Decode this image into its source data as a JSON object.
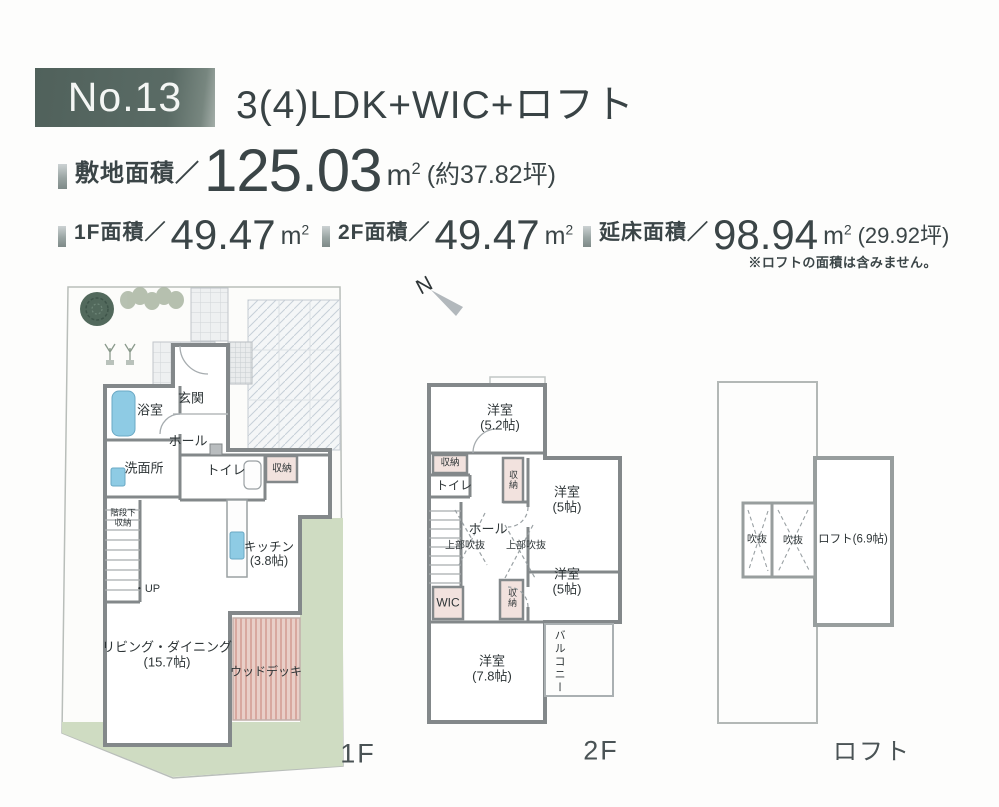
{
  "header": {
    "number": "No.13",
    "title": "3(4)LDK+WIC+ロフト"
  },
  "stats": {
    "unit": "m",
    "unit_sup": "2",
    "site_label": "敷地面積／",
    "site_value": "125.03",
    "site_note": "(約37.82坪)",
    "f1_label": "1F面積／",
    "f1_value": "49.47",
    "f2_label": "2F面積／",
    "f2_value": "49.47",
    "total_label": "延床面積／",
    "total_value": "98.94",
    "total_note": "(29.92坪)",
    "loft_note": "※ロフトの面積は含みません。"
  },
  "compass": {
    "north": "N"
  },
  "plan1f": {
    "floor_label": "1F",
    "rooms": {
      "bath": "浴室",
      "entrance": "玄関",
      "hall": "ホール",
      "washroom": "洗面所",
      "toilet": "トイレ",
      "storage": "収納",
      "under_stairs_line1": "階段下",
      "under_stairs_line2": "収納",
      "up": "・UP",
      "kitchen": "キッチン",
      "kitchen_size": "(3.8帖)",
      "living": "リビング・ダイニング",
      "living_size": "(15.7帖)",
      "wood_deck": "ウッドデッキ"
    }
  },
  "plan2f": {
    "floor_label": "2F",
    "rooms": {
      "bedroom1": "洋室",
      "bedroom1_size": "(5.2帖)",
      "storage_a": "収納",
      "toilet": "トイレ",
      "storage_b": "収納",
      "bedroom2": "洋室",
      "bedroom2_size": "(5帖)",
      "hall": "ホール",
      "void_left": "上部吹抜",
      "void_right": "上部吹抜",
      "wic": "WIC",
      "storage_c": "収納",
      "bedroom3": "洋室",
      "bedroom3_size": "(5帖)",
      "bedroom4": "洋室",
      "bedroom4_size": "(7.8帖)",
      "balcony": "バルコニー"
    }
  },
  "planloft": {
    "floor_label": "ロフト",
    "rooms": {
      "void1": "吹抜",
      "void2": "吹抜",
      "loft": "ロフト(6.9帖)"
    }
  },
  "colors": {
    "accent_box": "#586a64",
    "wall": "#83888a",
    "storage_fill": "#f2e2de",
    "water_fill": "#8ecbe4",
    "lawn": "#cfdcc2",
    "deck": "#dcaea5",
    "text": "#3b4547"
  }
}
